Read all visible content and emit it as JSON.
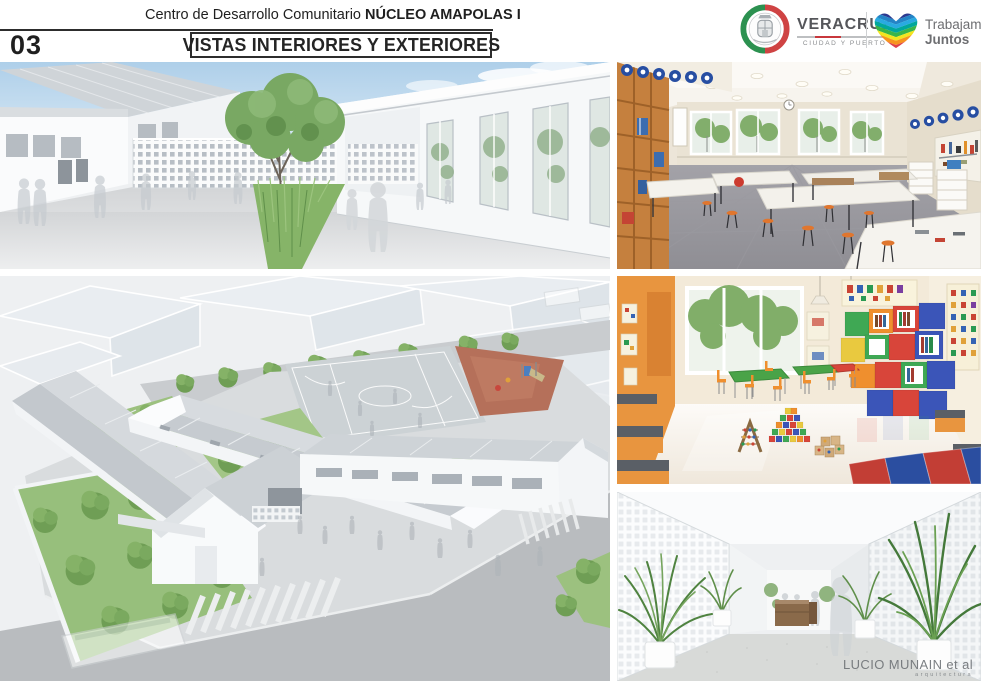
{
  "header": {
    "project_title_prefix": "Centro de Desarrollo Comunitario ",
    "project_title_emphasis": "NÚCLEO AMAPOLAS I",
    "sheet_number": "03",
    "sheet_title": "VISTAS INTERIORES Y EXTERIORES"
  },
  "logos": {
    "veracruz": {
      "wordmark": "VERACRUZ",
      "tagline": "CIUDAD Y PUERTO",
      "flag_green": "#2c9150",
      "flag_red": "#cf4343"
    },
    "trabajamos_juntos": {
      "word1": "Trabajamos",
      "word2": "Juntos",
      "stripe_colors": [
        "#2b3990",
        "#2484c6",
        "#29aae1",
        "#00a79d",
        "#3ab54a",
        "#f3e51f",
        "#f7941e",
        "#e04048",
        "#d6186e"
      ]
    }
  },
  "watermark": {
    "line1": "LUCIO MUNAIN et al",
    "line2": "arquitectura"
  }
}
